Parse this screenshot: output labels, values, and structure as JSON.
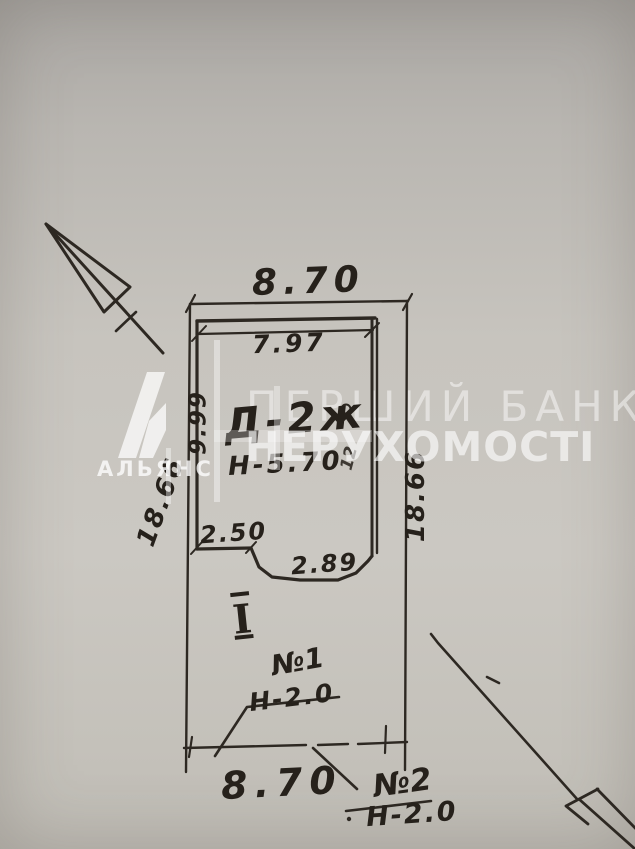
{
  "watermark": {
    "brand_line1": "ПЕРШИЙ БАНК",
    "brand_line2": "НЕРУХОМОСТІ",
    "logo_caption": "АЛЬЯНС",
    "color": "#ffffff"
  },
  "plan": {
    "kind": "hand-drawn site / floor plan sketch (BTI style)",
    "outer_width_top": "8.70",
    "inner_width_top": "7.97",
    "inner_height_left": "9.99",
    "outer_height_left": "18.66",
    "outer_height_right": "18.66",
    "ledge_width_left": "2.50",
    "notch_width_bottom": "2.89",
    "building_mark": "Д-2ж",
    "building_height": "Н-5.70",
    "section_mark": "I",
    "annex1_mark": "№1",
    "annex1_height": "Н-2.0",
    "outer_width_bottom": "8.70",
    "annex2_mark": "№2",
    "annex2_height": "Н-2.0",
    "side_note": "12",
    "ink_color": "#2d2822",
    "paper_color": "#c7c4be"
  }
}
